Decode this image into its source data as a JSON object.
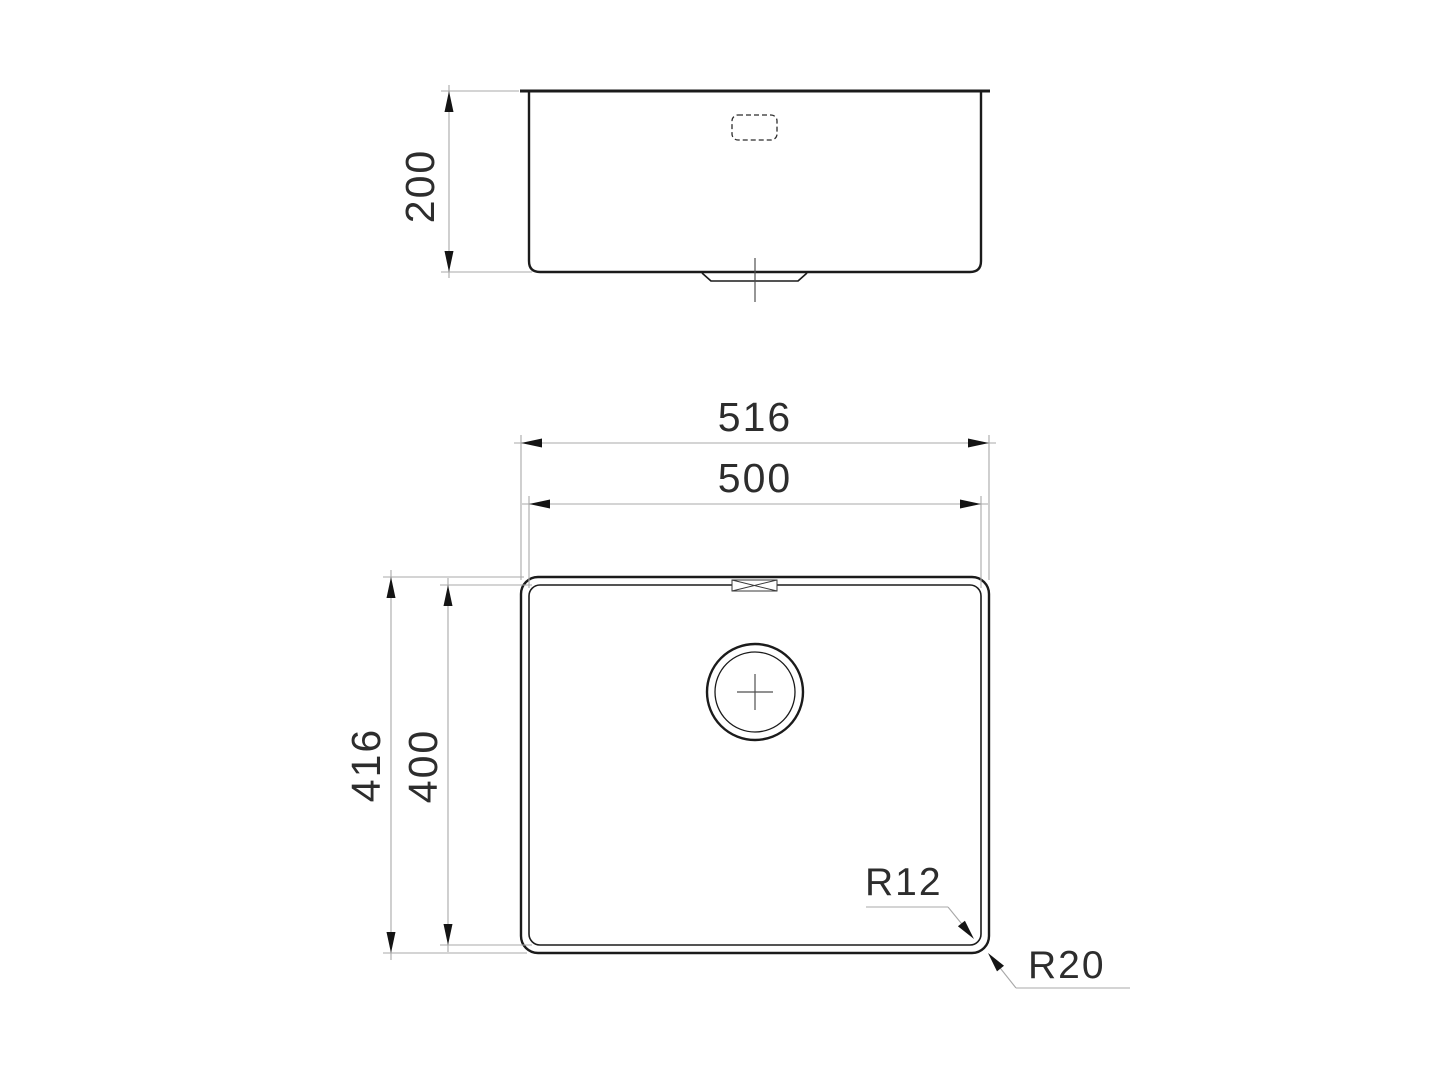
{
  "drawing": {
    "colors": {
      "background": "#ffffff",
      "outline": "#1b1b1b",
      "dimension_line": "#a8a8a8",
      "arrowhead": "#141414",
      "text": "#2d2d2d"
    },
    "side_view": {
      "depth_dim": "200"
    },
    "plan_view": {
      "overall_width_dim": "516",
      "bowl_width_dim": "500",
      "overall_depth_dim": "416",
      "bowl_depth_dim": "400",
      "bowl_corner_radius": "R12",
      "rim_corner_radius": "R20"
    }
  }
}
